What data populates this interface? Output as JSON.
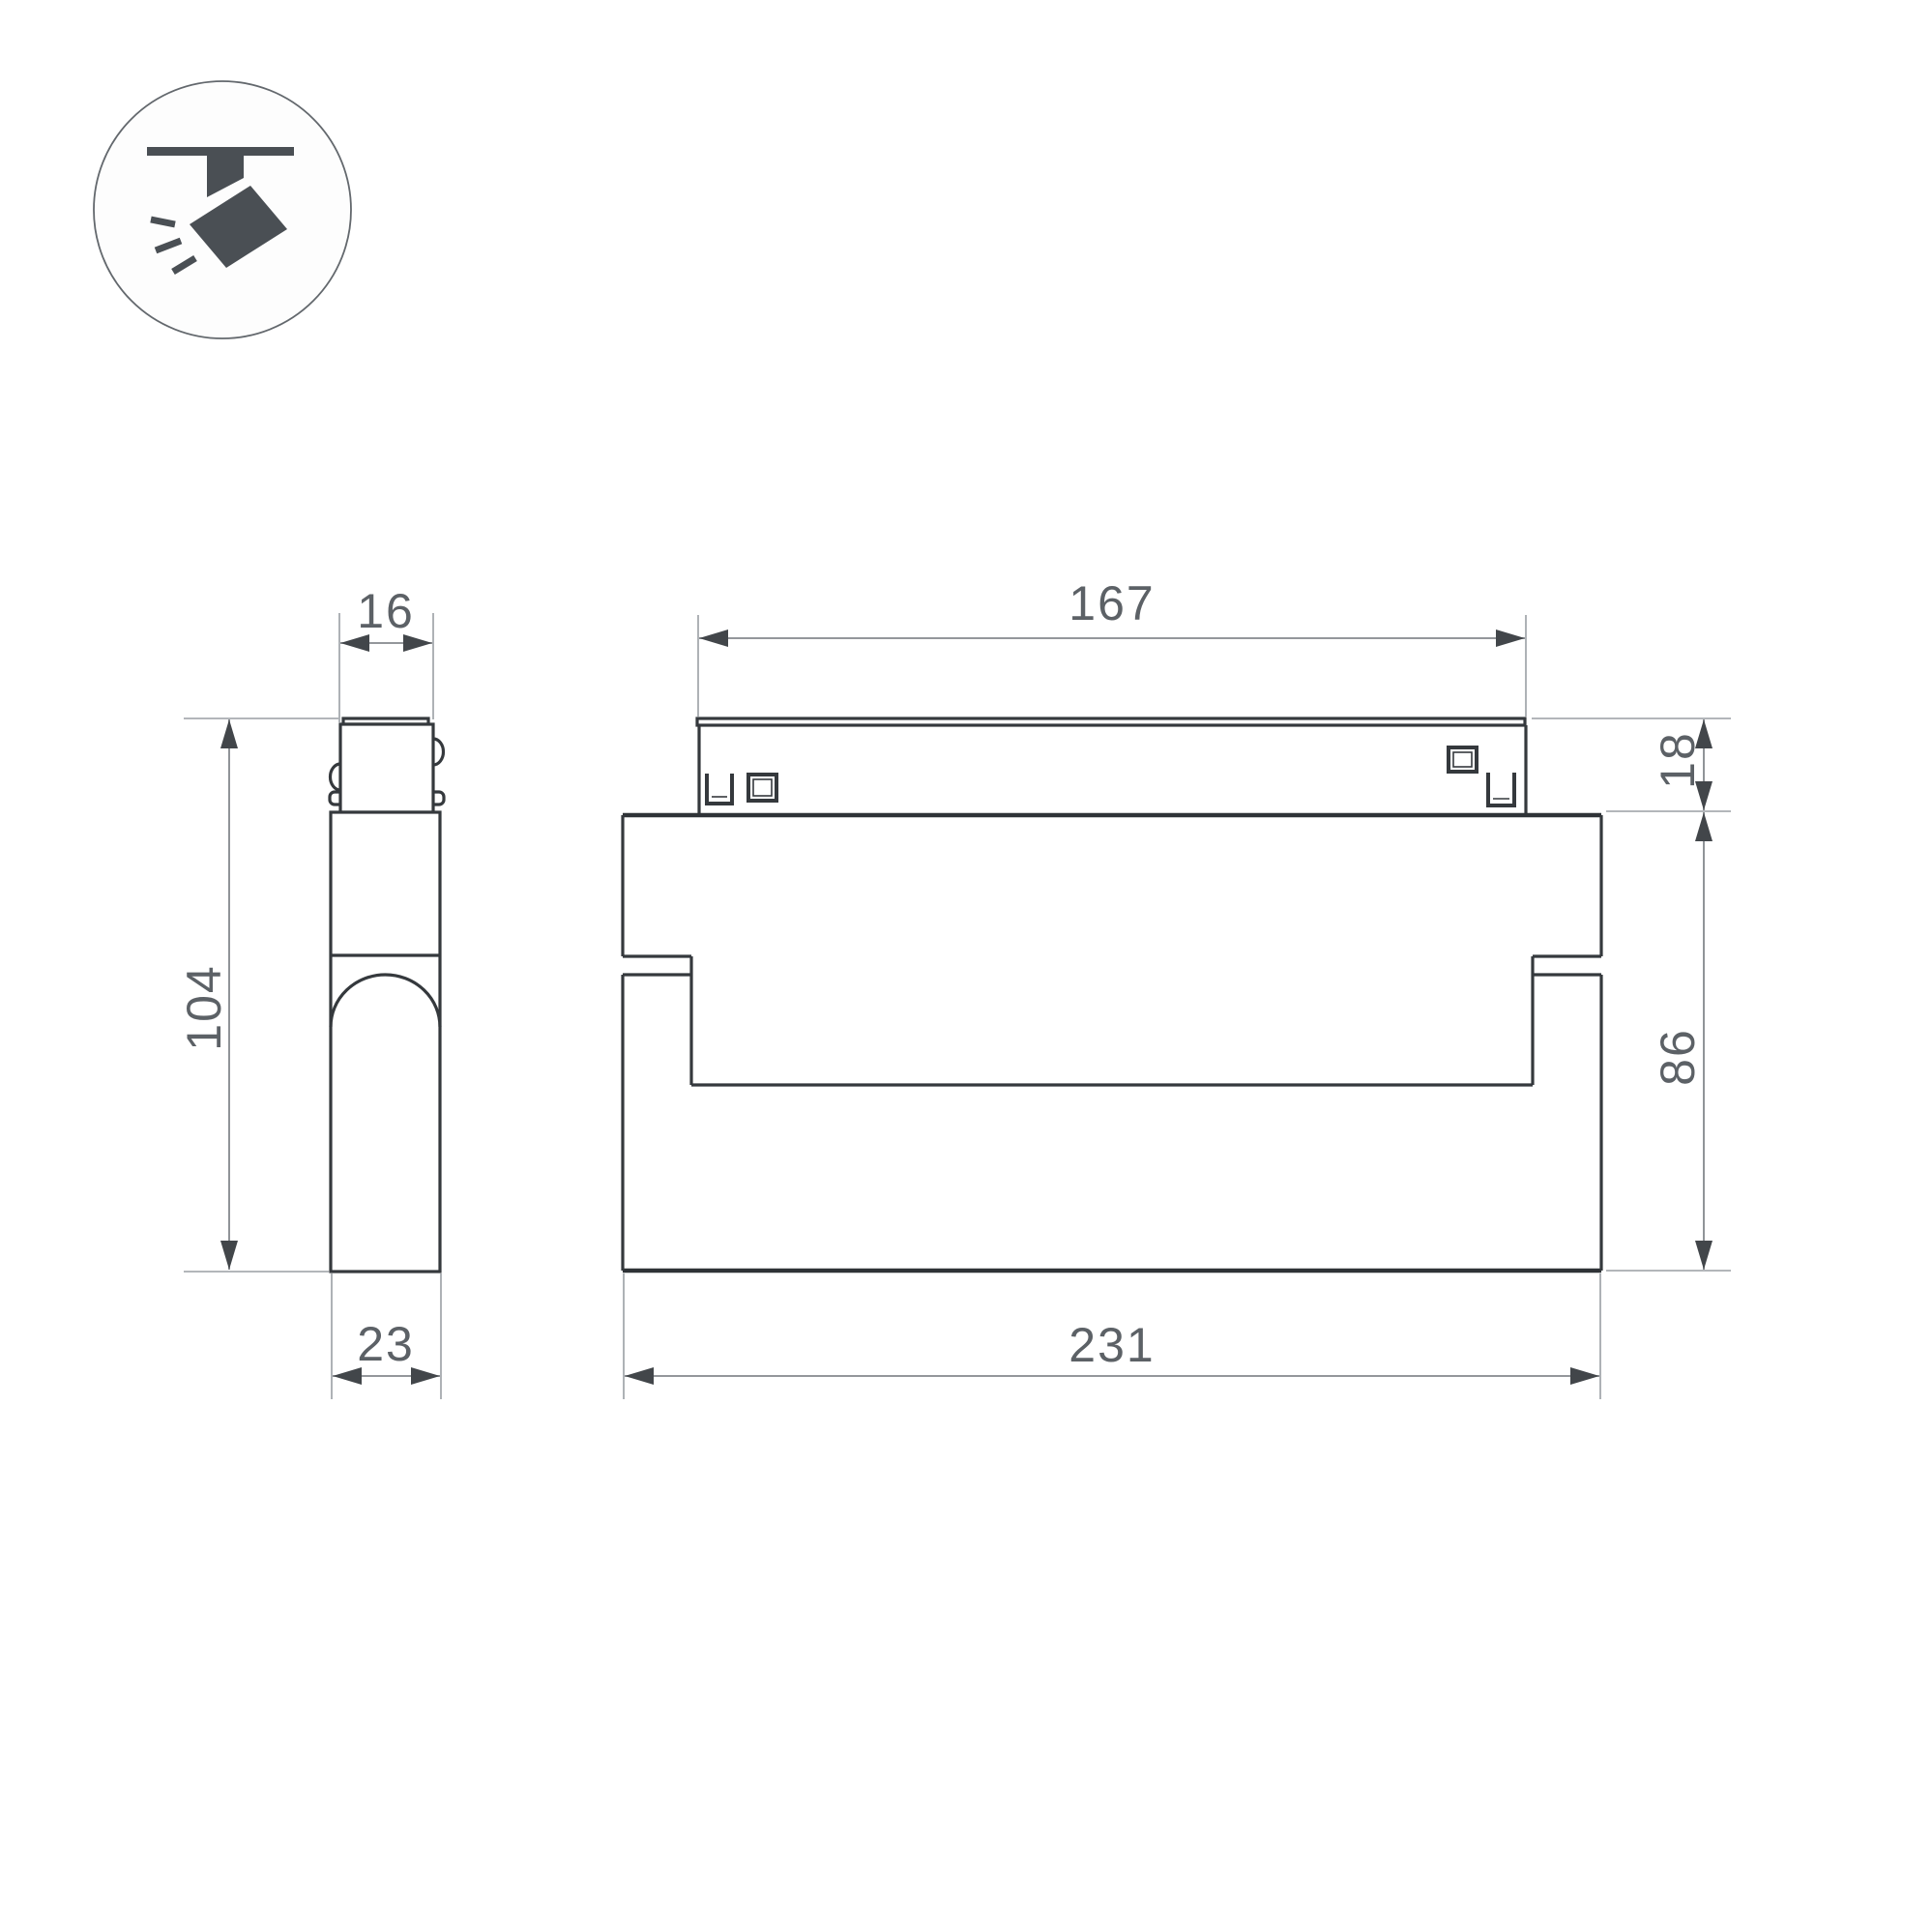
{
  "drawing": {
    "type": "technical-dimension-drawing",
    "subject": "magnetic-track-spotlight",
    "icon": "ceiling-track-spotlight-icon",
    "colors": {
      "background": "#ffffff",
      "part_outline": "#35393d",
      "dimension_line": "#84888d",
      "extension_line": "#9a9ea3",
      "arrow": "#42464a",
      "text": "#5c6166",
      "icon": "#4a4f54"
    },
    "views": {
      "side_view": "lamp side profile with track adapter stem",
      "front_view": "lamp front profile with track adapter bar"
    },
    "dims": {
      "side_stem_width": "16",
      "side_total_height": "104",
      "side_body_depth": "23",
      "front_track_length": "167",
      "front_track_height": "18",
      "front_body_height": "86",
      "front_body_length": "231"
    }
  }
}
